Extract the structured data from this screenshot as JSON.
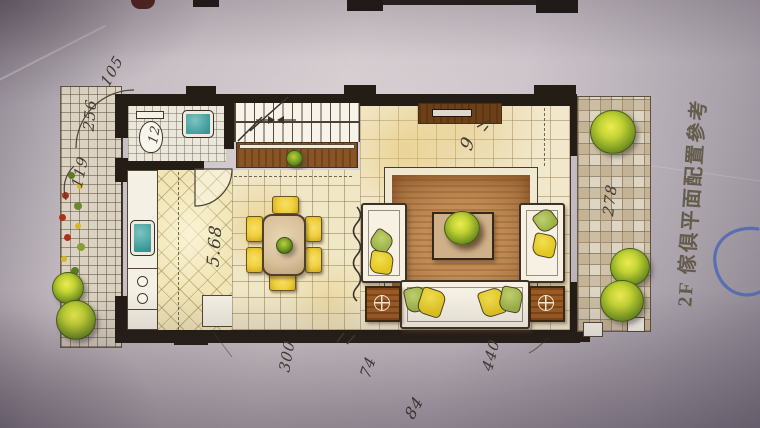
{
  "caption": {
    "floor_label_text": "2F 傢俱平面配置參考"
  },
  "annotations": {
    "top_left_a": "105",
    "top_left_b": "256",
    "left_c": "119",
    "bathroom": "12",
    "dining_width": "5.68",
    "living_mark": "9",
    "right_balcony": "278",
    "bottom_a": "300",
    "bottom_b": "74",
    "bottom_c": "440",
    "bottom_d": "84"
  },
  "colors": {
    "pen_blue": "#4f66b4",
    "handwriting_ink": "#423b32",
    "caption_ink": "#57503b",
    "wall_black": "#241d15",
    "wood_brown": "#8a5526",
    "sink_teal": "#3f9d9b",
    "cushion_yellow": "#e2c61e",
    "cushion_green": "#9cb246",
    "rug_brown": "#c28c56",
    "paper_gray": "#cfc6c9"
  }
}
